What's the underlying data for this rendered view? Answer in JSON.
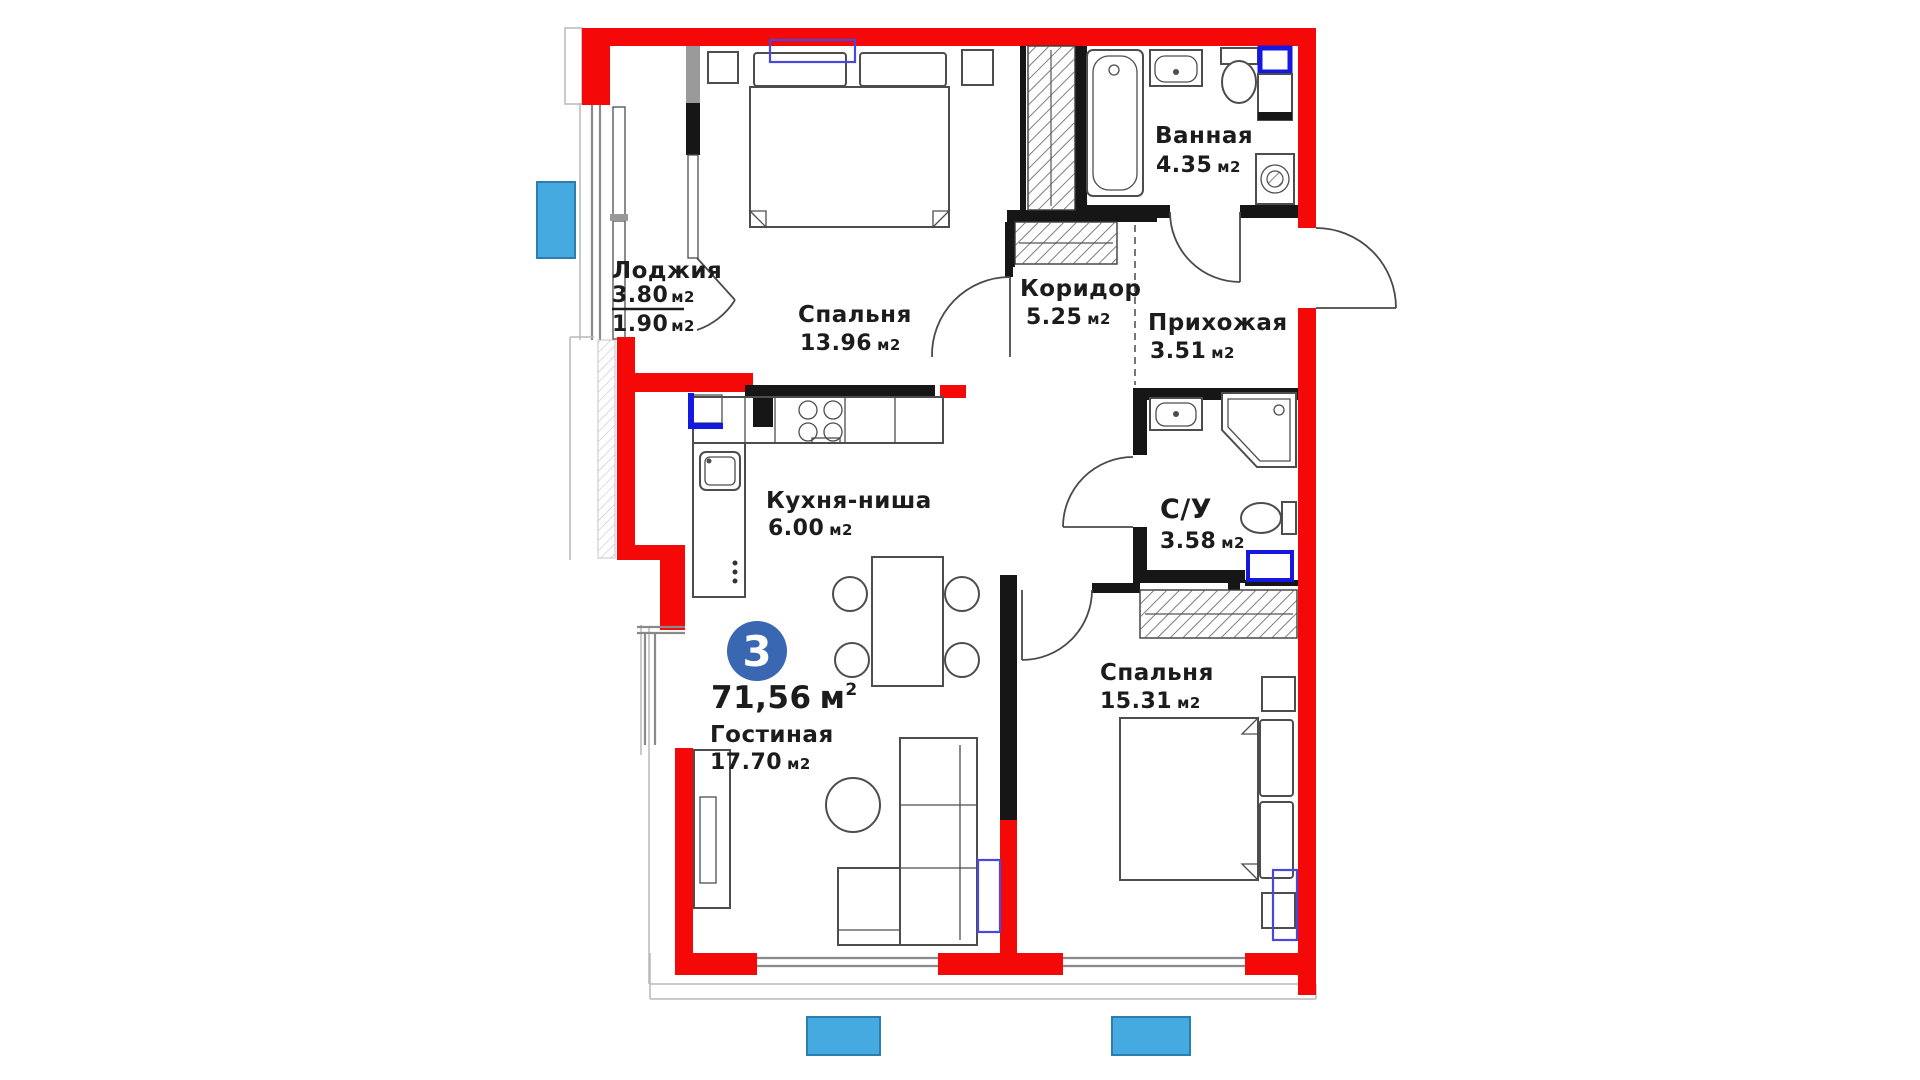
{
  "plan": {
    "badge": {
      "rooms": "3"
    },
    "total": {
      "value": "71,56",
      "unit": "м",
      "sup": "2"
    },
    "rooms": [
      {
        "id": "loggia",
        "name": "Лоджия",
        "area_value": "3.80",
        "area_unit": "м2",
        "area2_value": "1.90",
        "area2_unit": "м2"
      },
      {
        "id": "bedroom1",
        "name": "Спальня",
        "area_value": "13.96",
        "area_unit": "м2"
      },
      {
        "id": "bathroom",
        "name": "Ванная",
        "area_value": "4.35",
        "area_unit": "м2"
      },
      {
        "id": "corridor",
        "name": "Коридор",
        "area_value": "5.25",
        "area_unit": "м2"
      },
      {
        "id": "hallway",
        "name": "Прихожая",
        "area_value": "3.51",
        "area_unit": "м2"
      },
      {
        "id": "kitchen",
        "name": "Кухня-ниша",
        "area_value": "6.00",
        "area_unit": "м2"
      },
      {
        "id": "wc",
        "name": "С/У",
        "area_value": "3.58",
        "area_unit": "м2"
      },
      {
        "id": "living",
        "name": "Гостиная",
        "area_value": "17.70",
        "area_unit": "м2"
      },
      {
        "id": "bedroom2",
        "name": "Спальня",
        "area_value": "15.31",
        "area_unit": "м2"
      }
    ],
    "colors": {
      "wall_red": "#f50808",
      "wall_black": "#161616",
      "window_gray": "#8a8a8a",
      "furniture_gray": "#4d4d4d",
      "marker_cyan": "#45aadf",
      "accent_blue": "#1518e0",
      "outline_blue": "#4848dc",
      "badge_blue": "#3a67b2",
      "label_dark": "#1c1c1c"
    }
  }
}
